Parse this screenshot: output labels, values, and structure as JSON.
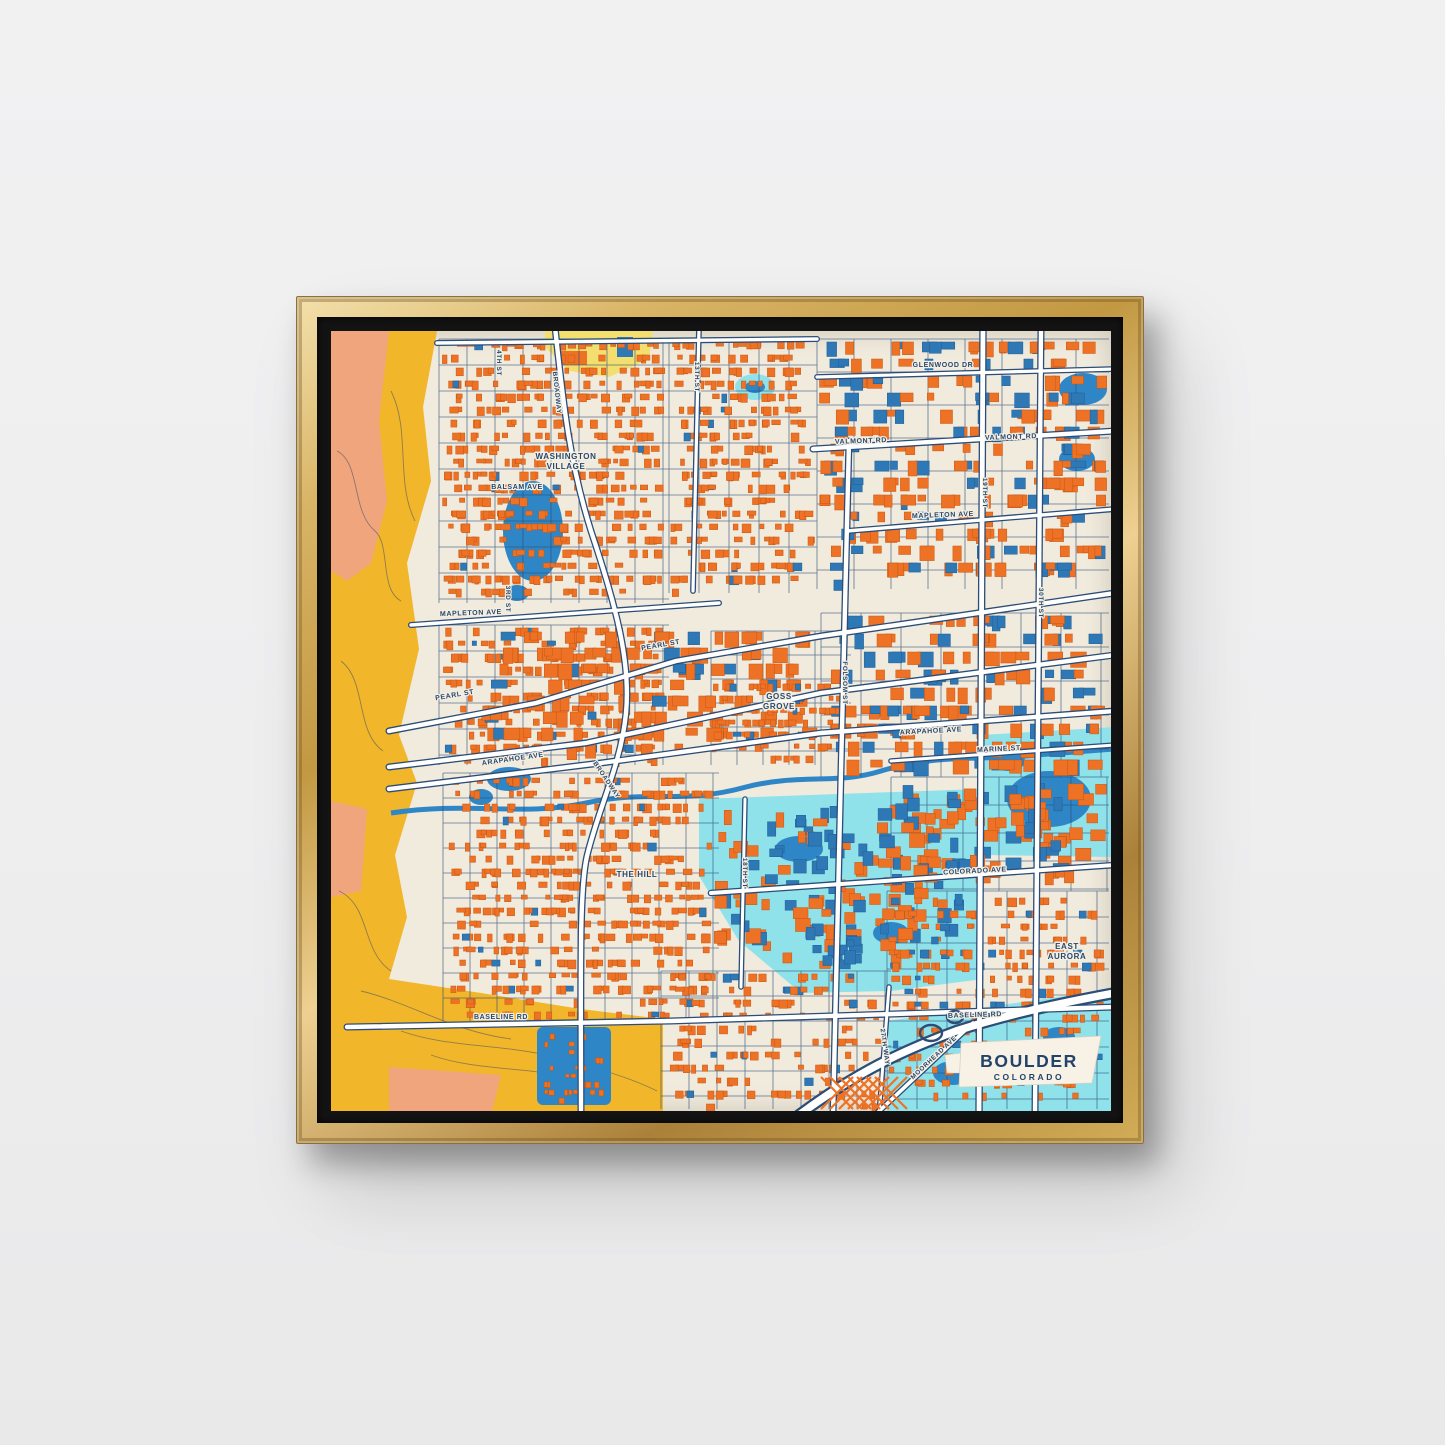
{
  "artwork": {
    "title": "BOULDER",
    "subtitle": "COLORADO"
  },
  "map": {
    "colors": {
      "wall": "#eeeeef",
      "frame_gold": "#c29842",
      "mat_black": "#131313",
      "map_base": "#f1ebdd",
      "building_orange": "#ee7226",
      "building_orange_dark": "#c8560f",
      "building_blue": "#2f78b6",
      "building_blue_dark": "#1f5d94",
      "water_blue": "#2e86c6",
      "water_cyan": "#8fe2ea",
      "mountain_yellow": "#f2b62b",
      "mountain_salmon": "#f0a57d",
      "park_yellow": "#f2df70",
      "road_navy": "#2b4d77",
      "road_white": "#ffffff",
      "label_navy": "#27476e",
      "label_halo": "#f4efe2",
      "card_bg": "#f7f2e5"
    },
    "labels": [
      {
        "text": "WASHINGTON",
        "x": 235,
        "y": 128,
        "size": 8
      },
      {
        "text": "VILLAGE",
        "x": 235,
        "y": 138,
        "size": 8
      },
      {
        "text": "BALSAM AVE",
        "x": 186,
        "y": 158,
        "size": 7
      },
      {
        "text": "MAPLETON AVE",
        "x": 140,
        "y": 284,
        "size": 7,
        "rot": -2
      },
      {
        "text": "MAPLETON AVE",
        "x": 612,
        "y": 186,
        "size": 7,
        "rot": -2
      },
      {
        "text": "VALMONT RD",
        "x": 530,
        "y": 112,
        "size": 7,
        "rot": -2
      },
      {
        "text": "VALMONT RD",
        "x": 680,
        "y": 108,
        "size": 7,
        "rot": -2
      },
      {
        "text": "GLENWOOD DR",
        "x": 612,
        "y": 36,
        "size": 7
      },
      {
        "text": "PEARL ST",
        "x": 124,
        "y": 366,
        "size": 7,
        "rot": -10
      },
      {
        "text": "PEARL ST",
        "x": 330,
        "y": 316,
        "size": 7,
        "rot": -10
      },
      {
        "text": "GOSS",
        "x": 448,
        "y": 368,
        "size": 8
      },
      {
        "text": "GROVE",
        "x": 448,
        "y": 378,
        "size": 8
      },
      {
        "text": "ARAPAHOE AVE",
        "x": 182,
        "y": 430,
        "size": 7,
        "rot": -8
      },
      {
        "text": "ARAPAHOE AVE",
        "x": 600,
        "y": 402,
        "size": 7,
        "rot": -3
      },
      {
        "text": "MARINE ST",
        "x": 668,
        "y": 420,
        "size": 7,
        "rot": -3
      },
      {
        "text": "THE HILL",
        "x": 306,
        "y": 546,
        "size": 8
      },
      {
        "text": "COLORADO AVE",
        "x": 644,
        "y": 542,
        "size": 7,
        "rot": -3
      },
      {
        "text": "EAST",
        "x": 736,
        "y": 618,
        "size": 8
      },
      {
        "text": "AURORA",
        "x": 736,
        "y": 628,
        "size": 8
      },
      {
        "text": "BASELINE RD",
        "x": 170,
        "y": 688,
        "size": 7
      },
      {
        "text": "BASELINE RD",
        "x": 644,
        "y": 686,
        "size": 7,
        "rot": -2
      },
      {
        "text": "4TH ST",
        "x": 166,
        "y": 32,
        "size": 6.5,
        "rot": 90
      },
      {
        "text": "3RD ST",
        "x": 175,
        "y": 268,
        "size": 6.5,
        "rot": 90
      },
      {
        "text": "BROADWAY",
        "x": 224,
        "y": 62,
        "size": 6.5,
        "rot": 84
      },
      {
        "text": "13TH ST",
        "x": 364,
        "y": 46,
        "size": 6.5,
        "rot": 90
      },
      {
        "text": "19TH ST",
        "x": 652,
        "y": 162,
        "size": 6.5,
        "rot": 90
      },
      {
        "text": "30TH ST",
        "x": 708,
        "y": 272,
        "size": 6.5,
        "rot": 90
      },
      {
        "text": "FOLSOM ST",
        "x": 512,
        "y": 352,
        "size": 6.5,
        "rot": 90
      },
      {
        "text": "18TH ST",
        "x": 412,
        "y": 542,
        "size": 6.5,
        "rot": 90
      },
      {
        "text": "BROADWAY",
        "x": 274,
        "y": 450,
        "size": 6.5,
        "rot": 56
      },
      {
        "text": "MOORHEAD AVE",
        "x": 604,
        "y": 728,
        "size": 6.5,
        "rot": -43
      },
      {
        "text": "27TH WAY",
        "x": 552,
        "y": 716,
        "size": 6.5,
        "rot": 82
      }
    ]
  }
}
